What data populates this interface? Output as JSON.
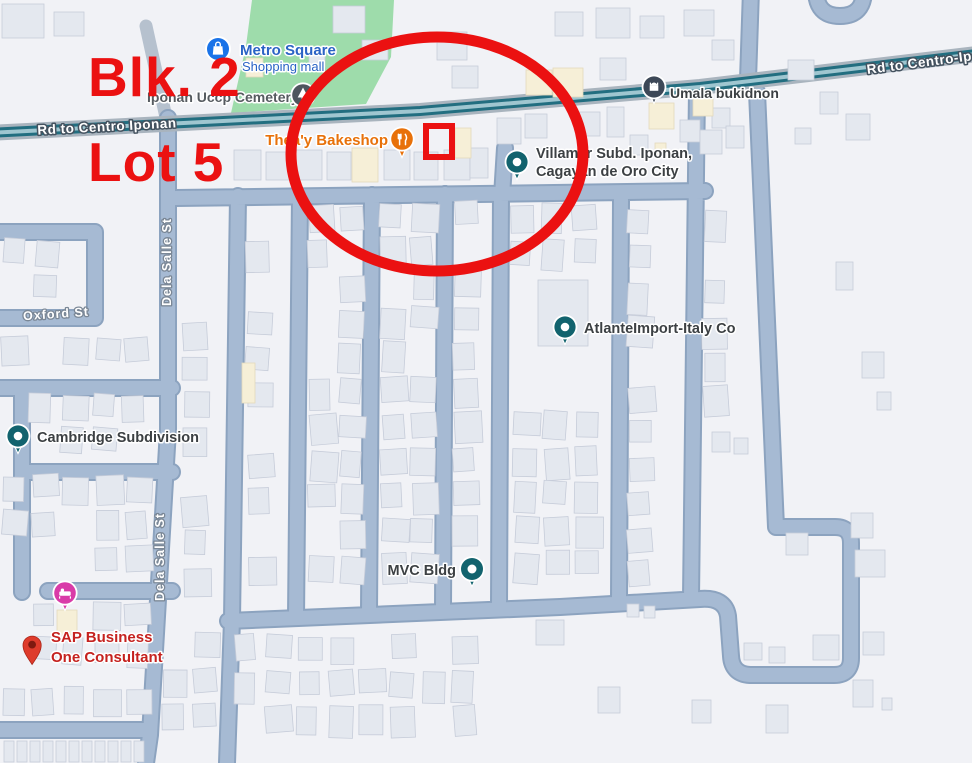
{
  "map": {
    "annotations": {
      "block_label": "Blk. 2",
      "lot_label": "Lot 5",
      "color": "#EB1111"
    },
    "road_labels": {
      "main_left": "Rd to Centro Iponan",
      "main_right": "Rd to Centro-Ipon",
      "oxford": "Oxford St",
      "dela_salle_upper": "Dela Salle St",
      "dela_salle_lower": "Dela Salle St"
    },
    "pois": {
      "metro_square": {
        "name": "Metro Square",
        "subtitle": "Shopping mall",
        "icon": "shopping-mall-icon",
        "color": "#1A73E8",
        "label_color": "#2A63C5"
      },
      "cemetery": {
        "name": "Iponan Uccp Cemetery",
        "icon": "cemetery-tree-icon",
        "color": "#4E565E"
      },
      "bakeshop": {
        "name": "Thea'y Bakeshop",
        "icon": "restaurant-icon",
        "color": "#E8710A",
        "label_color": "#E8710A"
      },
      "umala": {
        "name": "Umala bukidnon",
        "icon": "mosque-icon",
        "color": "#3D4857"
      },
      "villamar": {
        "line1": "Villamar Subd. Iponan,",
        "line2": "Cagayan de Oro City",
        "icon": "place-dot-icon",
        "color": "#12636E"
      },
      "atlante": {
        "name": "AtlanteImport-Italy Co",
        "icon": "place-dot-icon",
        "color": "#12636E"
      },
      "cambridge": {
        "name": "Cambridge Subdivision",
        "icon": "place-dot-icon",
        "color": "#12636E"
      },
      "mvc": {
        "name": "MVC Bldg",
        "icon": "place-dot-icon",
        "color": "#12636E"
      },
      "lodging": {
        "icon": "lodging-bed-icon",
        "color": "#D93BA8"
      },
      "sap": {
        "line1": "SAP Business",
        "line2": "One Consultant",
        "icon": "map-pin-icon",
        "color": "#DE3B2B",
        "label_color": "#C5221F"
      }
    }
  }
}
